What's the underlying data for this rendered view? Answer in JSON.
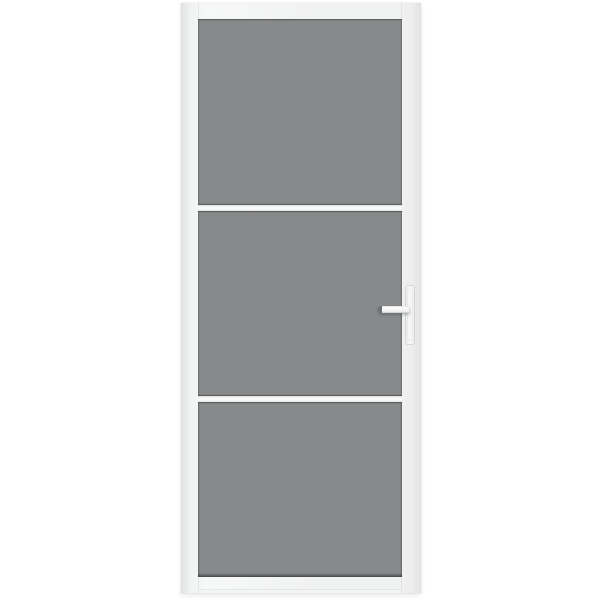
{
  "scene": {
    "subject": "white interior door with three tinted grey glass panels and lever handle, product photo on plain white background",
    "background_color": "#ffffff"
  },
  "door": {
    "frame_color": "#f1f2f2",
    "frame_highlight_color": "#f7f8f8",
    "frame_edge_color": "#e1e2e2",
    "glass_color": "#87898b",
    "glass_panel_count": 3,
    "glazing_bar_count": 2,
    "glazing_bar_color": "#fafafa",
    "glazing_bar_edge_color": "#d9dada"
  },
  "handle": {
    "side": "right",
    "backplate_color": "#f6f6f6",
    "backplate_border_color": "#d5d6d6",
    "lever_color": "#f5f5f5",
    "lever_end_cap_color": "#6f7274"
  }
}
